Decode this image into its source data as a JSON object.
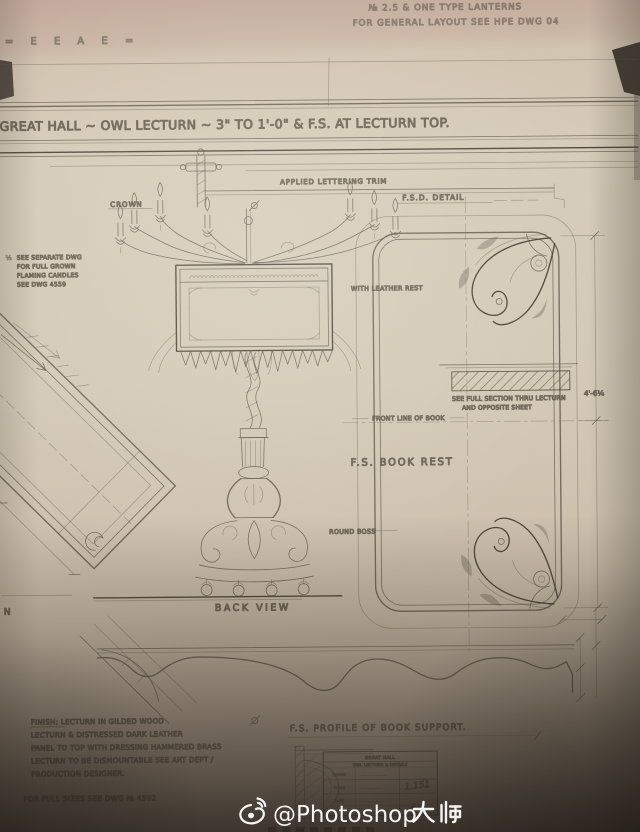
{
  "watermark": {
    "platform_icon": "weibo-icon",
    "handle": "@Photoshop大师",
    "handle_latin": "@Photoshop",
    "handle_cjk": "大师"
  },
  "sheet": {
    "corner_scribble": "= E E A E =",
    "top_note_line1": "№ 2.5 & ONE TYPE LANTERNS",
    "top_note_line2": "FOR GENERAL LAYOUT SEE HPE DWG 04",
    "title": "GREAT HALL ~ OWL LECTURN ~ 3\" TO 1'-0\" & F.S. AT LECTURN TOP.",
    "labels": {
      "crown": "CROWN",
      "applied_lettering": "APPLIED LETTERING TRIM",
      "fsd_detail": "F.S.D. DETAIL",
      "candle_note_marker": "½",
      "candle_note_1": "SEE SEPARATE DWG",
      "candle_note_2": "FOR FULL GROWN",
      "candle_note_3": "FLAMING CANDLES",
      "candle_note_4": "SEE DWG 4559",
      "with_leather_rest": "WITH LEATHER REST",
      "section_note_1": "SEE FULL SECTION THRU LECTURN",
      "section_note_2": "AND OPPOSITE SHEET",
      "front_line_of_book": "FRONT LINE OF BOOK",
      "fs_book_rest": "F.S. BOOK REST",
      "round_boss": "ROUND BOSS",
      "back_view": "BACK VIEW",
      "plan_label_cropped": "N",
      "dim_height": "4'-6¼",
      "profile_title": "F.S. PROFILE OF BOOK SUPPORT."
    },
    "finish_notes": {
      "line1": "FINISH: LECTURN IN GILDED WOOD",
      "line2": "LECTURN & DISTRESSED DARK LEATHER",
      "line3": "PANEL TO TOP WITH DRESSING HAMMERED BRASS",
      "line4": "LECTURN TO BE DISMOUNTABLE SEE ART DEPT /",
      "line5": "PRODUCTION DESIGNER.",
      "full_sizes": "FOR FULL SIZES SEE DWG № 4592"
    },
    "title_block": {
      "header_1": "GREAT HALL",
      "header_2": "OWL LECTURN & DETAILS",
      "row_drawn": "DRAWN",
      "row_scale": "SCALE",
      "row_date": "DATE",
      "drawing_number": "1.151",
      "initials": "E.V."
    },
    "colors": {
      "paper": "#d5ccba",
      "pencil": "#5a5245",
      "shadow": "#3a332b"
    }
  }
}
